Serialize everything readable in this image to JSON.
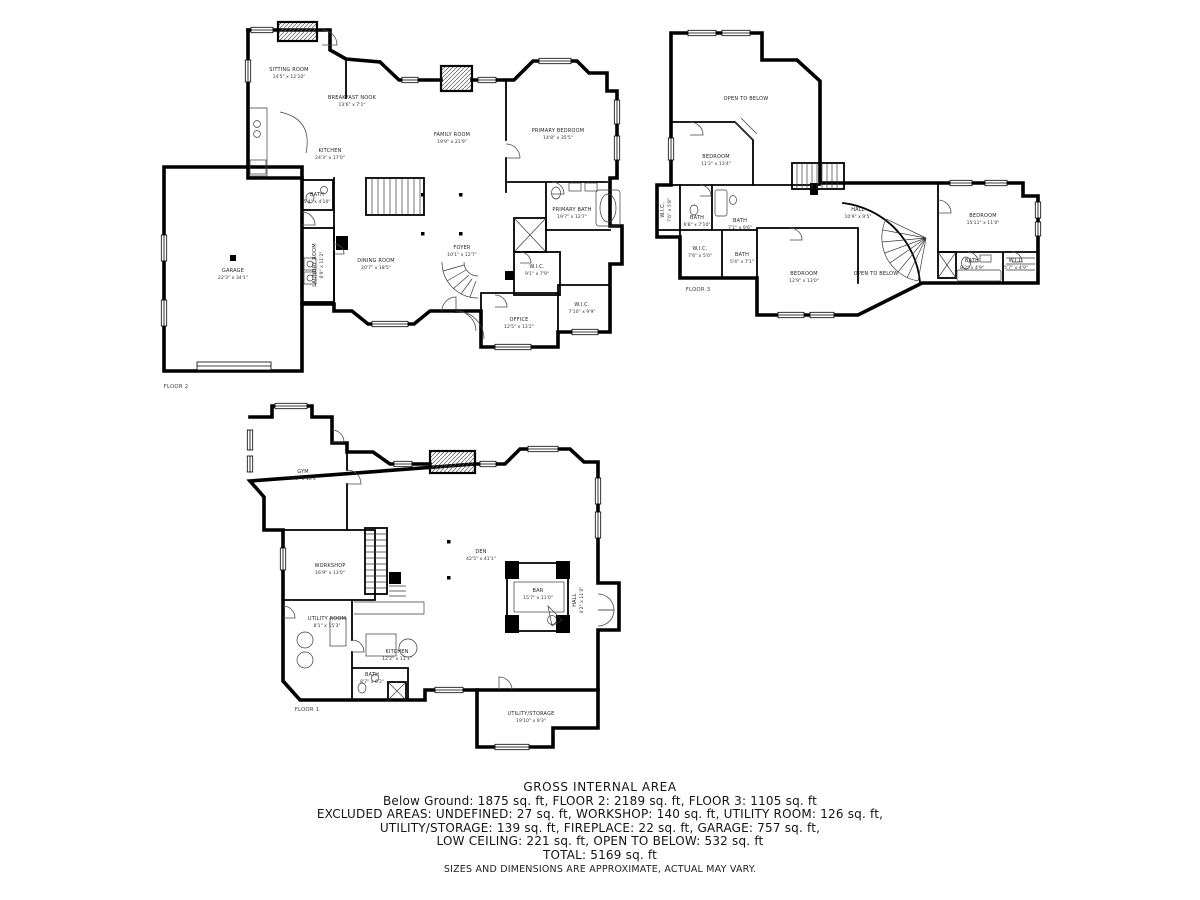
{
  "colors": {
    "wall": "#000000",
    "text": "#1e1e1e",
    "background": "#ffffff"
  },
  "floors": {
    "floor2": {
      "label": "FLOOR 2",
      "rooms": {
        "sitting_room": {
          "name": "SITTING ROOM",
          "dims": "14'5\" x 12'10\""
        },
        "breakfast_nook": {
          "name": "BREAKFAST NOOK",
          "dims": "13'6\" x 7'1\""
        },
        "kitchen": {
          "name": "KITCHEN",
          "dims": "24'3\" x 17'0\""
        },
        "family_room": {
          "name": "FAMILY ROOM",
          "dims": "19'9\" x 21'9\""
        },
        "primary_bedroom": {
          "name": "PRIMARY BEDROOM",
          "dims": "14'8\" x 35'5\""
        },
        "primary_bath": {
          "name": "PRIMARY BATH",
          "dims": "19'7\" x 12'7\""
        },
        "bath": {
          "name": "BATH",
          "dims": "5'4\" x 4'10\""
        },
        "laundry_room": {
          "name": "LAUNDRY ROOM",
          "dims": "6'9\" x 11'2\""
        },
        "dining_room": {
          "name": "DINING ROOM",
          "dims": "20'7\" x 18'5\""
        },
        "foyer": {
          "name": "FOYER",
          "dims": "10'1\" x 12'7\""
        },
        "office": {
          "name": "OFFICE",
          "dims": "12'5\" x 13'2\""
        },
        "wic_1": {
          "name": "W.I.C.",
          "dims": "9'1\" x 7'9\""
        },
        "wic_2": {
          "name": "W.I.C.",
          "dims": "7'10\" x 9'9\""
        },
        "garage": {
          "name": "GARAGE",
          "dims": "22'3\" x 34'1\""
        }
      }
    },
    "floor3": {
      "label": "FLOOR 3",
      "rooms": {
        "open_to_below_upper": {
          "name": "OPEN TO BELOW",
          "dims": ""
        },
        "bedroom_1": {
          "name": "BEDROOM",
          "dims": "11'2\" x 13'4\""
        },
        "wic_left": {
          "name": "W.I.C.",
          "dims": "7'6\" x 5'8\""
        },
        "bath_1": {
          "name": "BATH",
          "dims": "6'8\" x 7'10\""
        },
        "bath_2": {
          "name": "BATH",
          "dims": "7'1\" x 9'6\""
        },
        "wic_mid": {
          "name": "W.I.C.",
          "dims": "7'6\" x 5'0\""
        },
        "bath_3": {
          "name": "BATH",
          "dims": "5'4\" x 7'1\""
        },
        "bedroom_2": {
          "name": "BEDROOM",
          "dims": "12'9\" x 13'0\""
        },
        "hall": {
          "name": "HALL",
          "dims": "10'9\" x 9'5\""
        },
        "open_to_below_lower": {
          "name": "OPEN TO BELOW",
          "dims": ""
        },
        "bedroom_3": {
          "name": "BEDROOM",
          "dims": "15'11\" x 11'0\""
        },
        "bath_4": {
          "name": "BATH",
          "dims": "8'2\" x 4'9\""
        },
        "wil": {
          "name": "W.I.L.",
          "dims": "5'7\" x 4'9\""
        }
      }
    },
    "floor1": {
      "label": "FLOOR 1",
      "rooms": {
        "gym": {
          "name": "GYM",
          "dims": "17'8\" x 16'4\""
        },
        "workshop": {
          "name": "WORKSHOP",
          "dims": "16'9\" x 13'0\""
        },
        "utility_room": {
          "name": "UTILITY ROOM",
          "dims": "8'1\" x 15'3\""
        },
        "kitchen": {
          "name": "KITCHEN",
          "dims": "12'2\" x 11'1\""
        },
        "bath": {
          "name": "BATH",
          "dims": "8'7\" x 6'2\""
        },
        "den": {
          "name": "DEN",
          "dims": "42'5\" x 41'1\""
        },
        "bar": {
          "name": "BAR",
          "dims": "15'7\" x 11'0\""
        },
        "hall": {
          "name": "HALL",
          "dims": "4'2\" x 11'0\""
        },
        "utility_storage": {
          "name": "UTILITY/STORAGE",
          "dims": "19'10\" x 9'3\""
        }
      }
    }
  },
  "summary": {
    "title": "GROSS INTERNAL AREA",
    "line1": "Below Ground: 1875 sq. ft, FLOOR 2: 2189 sq. ft, FLOOR 3: 1105 sq. ft",
    "line2": "EXCLUDED AREAS: UNDEFINED: 27 sq. ft, WORKSHOP: 140 sq. ft, UTILITY ROOM: 126 sq. ft,",
    "line3": "UTILITY/STORAGE: 139 sq. ft, FIREPLACE: 22 sq. ft, GARAGE: 757 sq. ft,",
    "line4": "LOW CEILING: 221 sq. ft, OPEN TO BELOW: 532 sq. ft",
    "total": "TOTAL: 5169 sq. ft",
    "disclaimer": "SIZES AND DIMENSIONS ARE APPROXIMATE, ACTUAL MAY VARY."
  }
}
